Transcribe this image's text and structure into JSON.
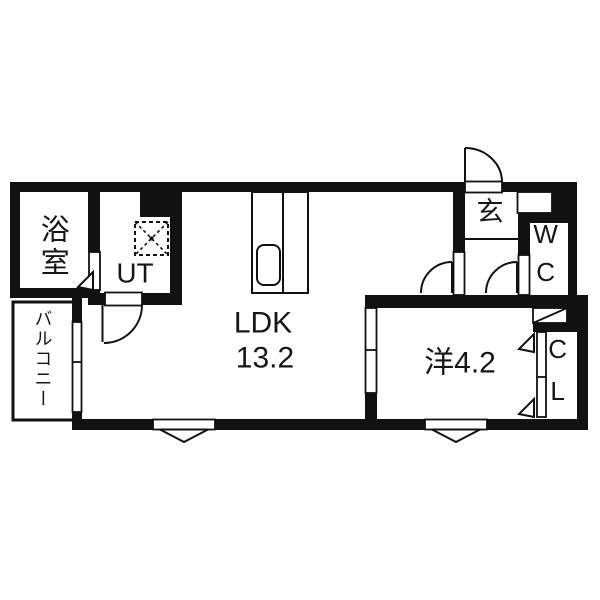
{
  "rooms": {
    "bathroom": {
      "label": "浴室"
    },
    "utility": {
      "label": "UT"
    },
    "ldk": {
      "label": "LDK",
      "area": "13.2"
    },
    "entrance": {
      "label": "玄"
    },
    "toilet": {
      "label": "WC"
    },
    "western_room": {
      "label": "洋4.2"
    },
    "closet": {
      "label": "CL"
    },
    "balcony": {
      "label": "バルコニー"
    }
  },
  "colors": {
    "wall": "#111111",
    "line": "#111111",
    "background": "#ffffff"
  }
}
